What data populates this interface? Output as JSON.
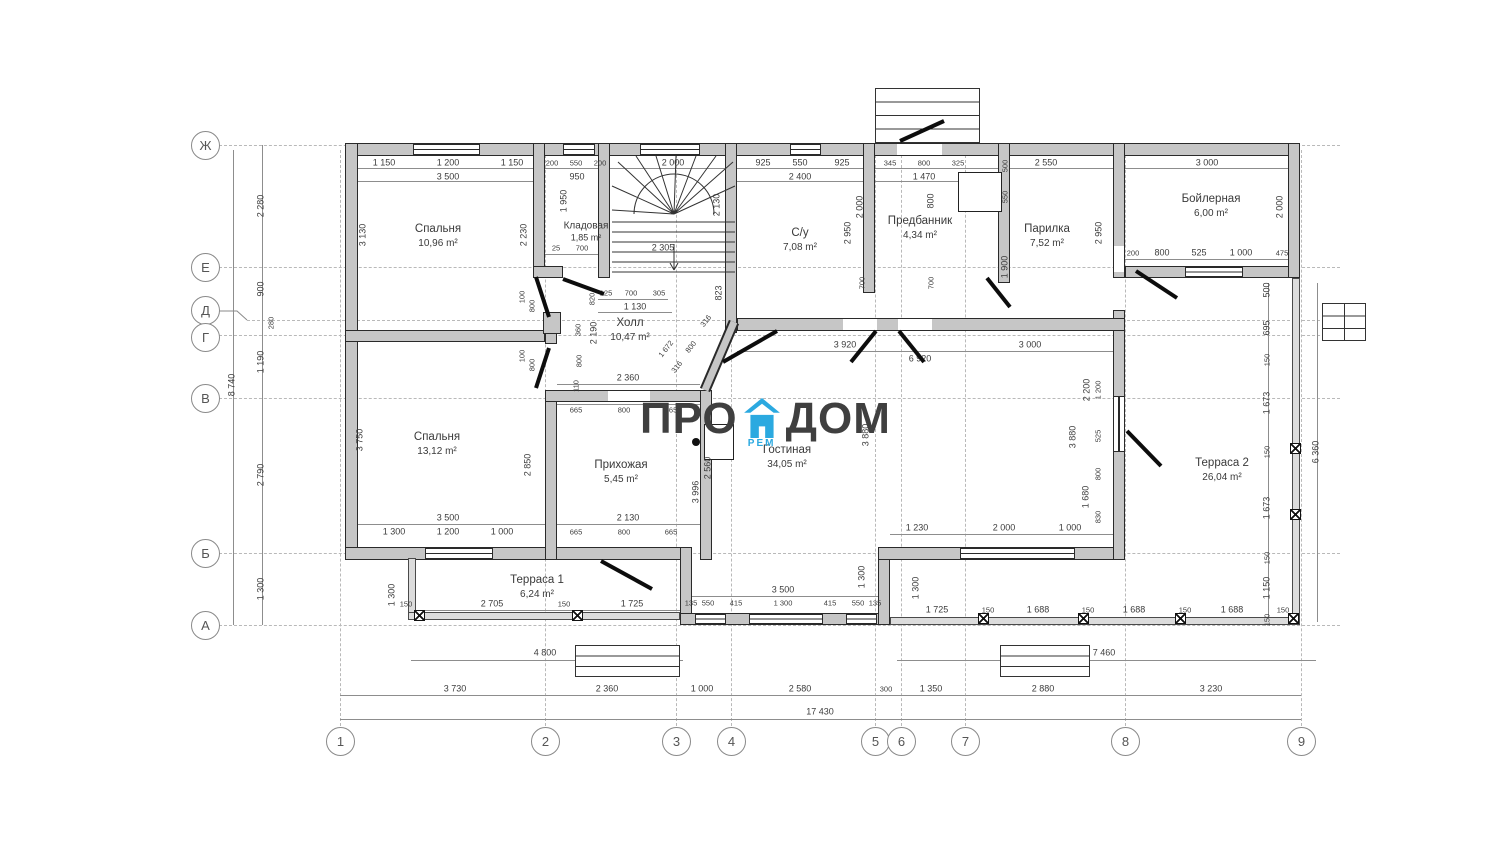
{
  "watermark": {
    "pro": "ПРО",
    "dom": "ДОМ",
    "rem": "РЕМ",
    "house_color": "#2ba9e0",
    "text_color": "#3f3f3f"
  },
  "colors": {
    "wall_fill": "#c6c6c6",
    "line": "#2a2a2a",
    "dim_text": "#3c3c3c",
    "grid": "#b9b9b9"
  },
  "axes": {
    "letters": [
      "Ж",
      "Е",
      "Д",
      "Г",
      "В",
      "Б",
      "А"
    ],
    "numbers": [
      "1",
      "2",
      "3",
      "4",
      "5",
      "6",
      "7",
      "8",
      "9"
    ]
  },
  "rooms": [
    {
      "name": "Спальня",
      "area": "10,96 m²"
    },
    {
      "name": "Кладовая",
      "area": "1,85 m²"
    },
    {
      "name": "Холл",
      "area": "10,47 m²"
    },
    {
      "name": "С/у",
      "area": "7,08 m²"
    },
    {
      "name": "Предбанник",
      "area": "4,34 m²"
    },
    {
      "name": "Парилка",
      "area": "7,52 m²"
    },
    {
      "name": "Бойлерная",
      "area": "6,00 m²"
    },
    {
      "name": "Спальня",
      "area": "13,12 m²"
    },
    {
      "name": "Прихожая",
      "area": "5,45 m²"
    },
    {
      "name": "Гостиная",
      "area": "34,05 m²"
    },
    {
      "name": "Терраса 1",
      "area": "6,24 m²"
    },
    {
      "name": "Терраса 2",
      "area": "26,04 m²"
    }
  ],
  "dims": {
    "top_row": [
      "1 150",
      "1 200",
      "1 150",
      "200",
      "550",
      "200",
      "2 000",
      "925",
      "550",
      "925",
      "345",
      "800",
      "325",
      "2 550",
      "3 000"
    ],
    "top_row2": [
      "3 500",
      "950",
      "2 400",
      "1 470"
    ],
    "left": [
      "2 280",
      "900",
      "280",
      "1 190",
      "2 790",
      "1 300",
      "8 740"
    ],
    "right": [
      "500",
      "695",
      "150",
      "1 673",
      "150",
      "1 673",
      "150",
      "1 150",
      "150",
      "6 360"
    ],
    "bottom": [
      "3 730",
      "2 360",
      "1 000",
      "2 580",
      "300",
      "1 350",
      "2 880",
      "3 230",
      "17 430"
    ],
    "boiler": [
      "200",
      "800",
      "525",
      "1 000",
      "475",
      "2 000",
      "2 950"
    ],
    "bath": [
      "2 000",
      "2 950",
      "700",
      "800",
      "700",
      "1 900",
      "550",
      "500"
    ],
    "stairs": [
      "2 305",
      "2 130",
      "823"
    ],
    "klad": [
      "1 950",
      "25",
      "700"
    ],
    "hall": [
      "125",
      "700",
      "305",
      "1 130",
      "820",
      "2 190",
      "360",
      "800",
      "110",
      "2 360",
      "316",
      "800",
      "316",
      "1 672"
    ],
    "doors": [
      "100",
      "800",
      "100",
      "800"
    ],
    "bed1": [
      "3 130",
      "2 230"
    ],
    "bed2": [
      "3 750",
      "2 850",
      "3 500",
      "1 300",
      "1 200",
      "1 000"
    ],
    "hallway": [
      "665",
      "800",
      "665",
      "2 130",
      "665",
      "800",
      "665",
      "2 560",
      "3 996"
    ],
    "liv": [
      "3 920",
      "3 000",
      "6 920",
      "3 880",
      "3 880",
      "2 200",
      "1 200",
      "525",
      "800",
      "1 680",
      "830",
      "1 230",
      "2 000",
      "1 000",
      "1 300",
      "1 300"
    ],
    "bay": [
      "3 500",
      "135",
      "550",
      "415",
      "1 300",
      "415",
      "550",
      "135"
    ],
    "ter1": [
      "1 300",
      "150",
      "2 705",
      "150",
      "1 725",
      "4 800"
    ],
    "ter2": [
      "1 725",
      "150",
      "1 688",
      "150",
      "1 688",
      "150",
      "1 688",
      "150",
      "7 460"
    ]
  }
}
